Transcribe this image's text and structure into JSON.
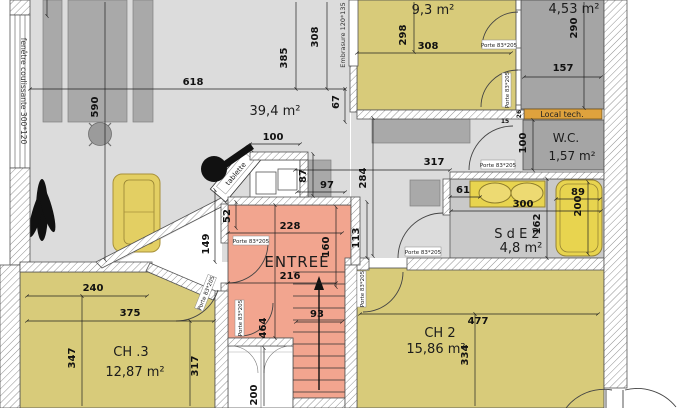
{
  "colors": {
    "room_yellow": "#d8cb7a",
    "room_salmon": "#f2a58f",
    "room_dark": "#a5a5a5",
    "floor_gray": "#dcdcdc",
    "sde_gray": "#c9c9c9",
    "local_tech_orange": "#dfa23d",
    "furniture_gray": "#a9a9a9",
    "sofa_yellow": "#e3cf63"
  },
  "rooms": {
    "living": {
      "area": "39,4 m²"
    },
    "bed1": {
      "area": "9,3 m²"
    },
    "dressing": {
      "area": "4,53 m²"
    },
    "wc": {
      "name": "W.C.",
      "area": "1,57 m²"
    },
    "sde2": {
      "name": "S d E 2",
      "area": "4,8 m²"
    },
    "entree": {
      "name": "ENTREE"
    },
    "ch2": {
      "name": "CH 2",
      "area": "15,86 m²"
    },
    "ch3": {
      "name": "CH .3",
      "area": "12,87 m²"
    },
    "local_tech": {
      "name": "Local tech."
    }
  },
  "labels": {
    "window_left": "fenêtre coulissante 300*120",
    "embrasure": "Embrasure 120*135",
    "door": "Porte 83*205",
    "tablette": "tablette"
  },
  "dims": {
    "d618": "618",
    "d590": "590",
    "d385": "385",
    "d308_vert": "308",
    "d67": "67",
    "d100_desk": "100",
    "d87": "87",
    "d97": "97",
    "d284": "284",
    "d317_hall": "317",
    "d113": "113",
    "d52": "52",
    "d149": "149",
    "d228": "228",
    "d160": "160",
    "d216": "216",
    "d464": "464",
    "d298": "298",
    "d308_room": "308",
    "d290": "290",
    "d157": "157",
    "d26": "26",
    "d15": "15",
    "d100_wc": "100",
    "d61": "61",
    "d300": "300",
    "d162": "162",
    "d89": "89",
    "d200_bath": "200",
    "d240": "240",
    "d375": "375",
    "d347": "347",
    "d317_ch3": "317",
    "d477": "477",
    "d334": "334",
    "d93": "93",
    "d200_closet": "200"
  }
}
